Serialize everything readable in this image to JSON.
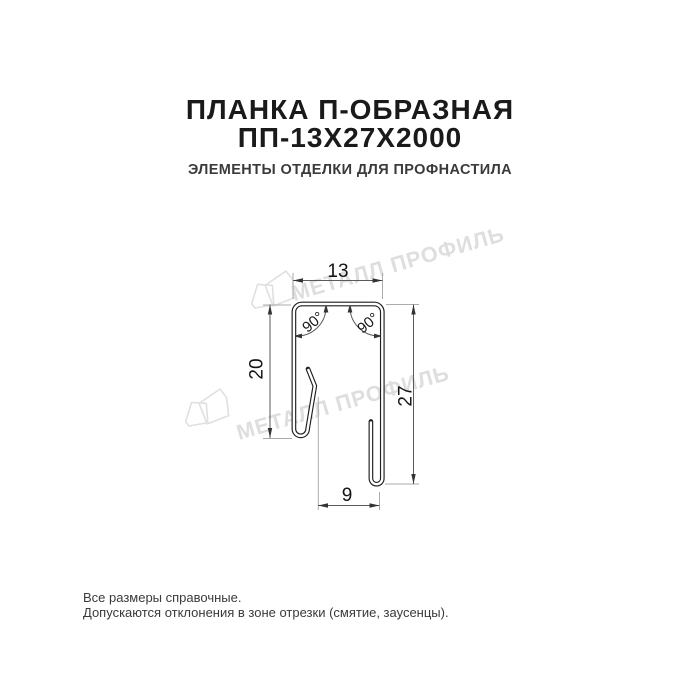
{
  "header": {
    "title_line1": "ПЛАНКА П-ОБРАЗНАЯ",
    "title_line2": "ПП-13Х27Х2000",
    "subtitle": "ЭЛЕМЕНТЫ ОТДЕЛКИ ДЛЯ ПРОФНАСТИЛА"
  },
  "drawing": {
    "type": "technical-cross-section",
    "dimensions": {
      "top_width": "13",
      "left_height": "20",
      "right_height": "27",
      "bottom_hook_gap": "9",
      "angle_left": "90°",
      "angle_right": "90°"
    }
  },
  "watermark": {
    "text": "МЕТАЛЛ ПРОФИЛЬ",
    "logo": "metall-profil-logo"
  },
  "footer": {
    "line1": "Все размеры справочные.",
    "line2": "Допускаются отклонения в зоне отрезки (смятие, заусенцы)."
  },
  "colors": {
    "background": "#ffffff",
    "title": "#1a1a1a",
    "subtitle": "#3a3a3a",
    "profile_line": "#1e1e1e",
    "dimension_line": "#5a5a5a",
    "extension_line": "#ababab",
    "watermark": "#dedede",
    "footer_text": "#3a3a3a"
  }
}
